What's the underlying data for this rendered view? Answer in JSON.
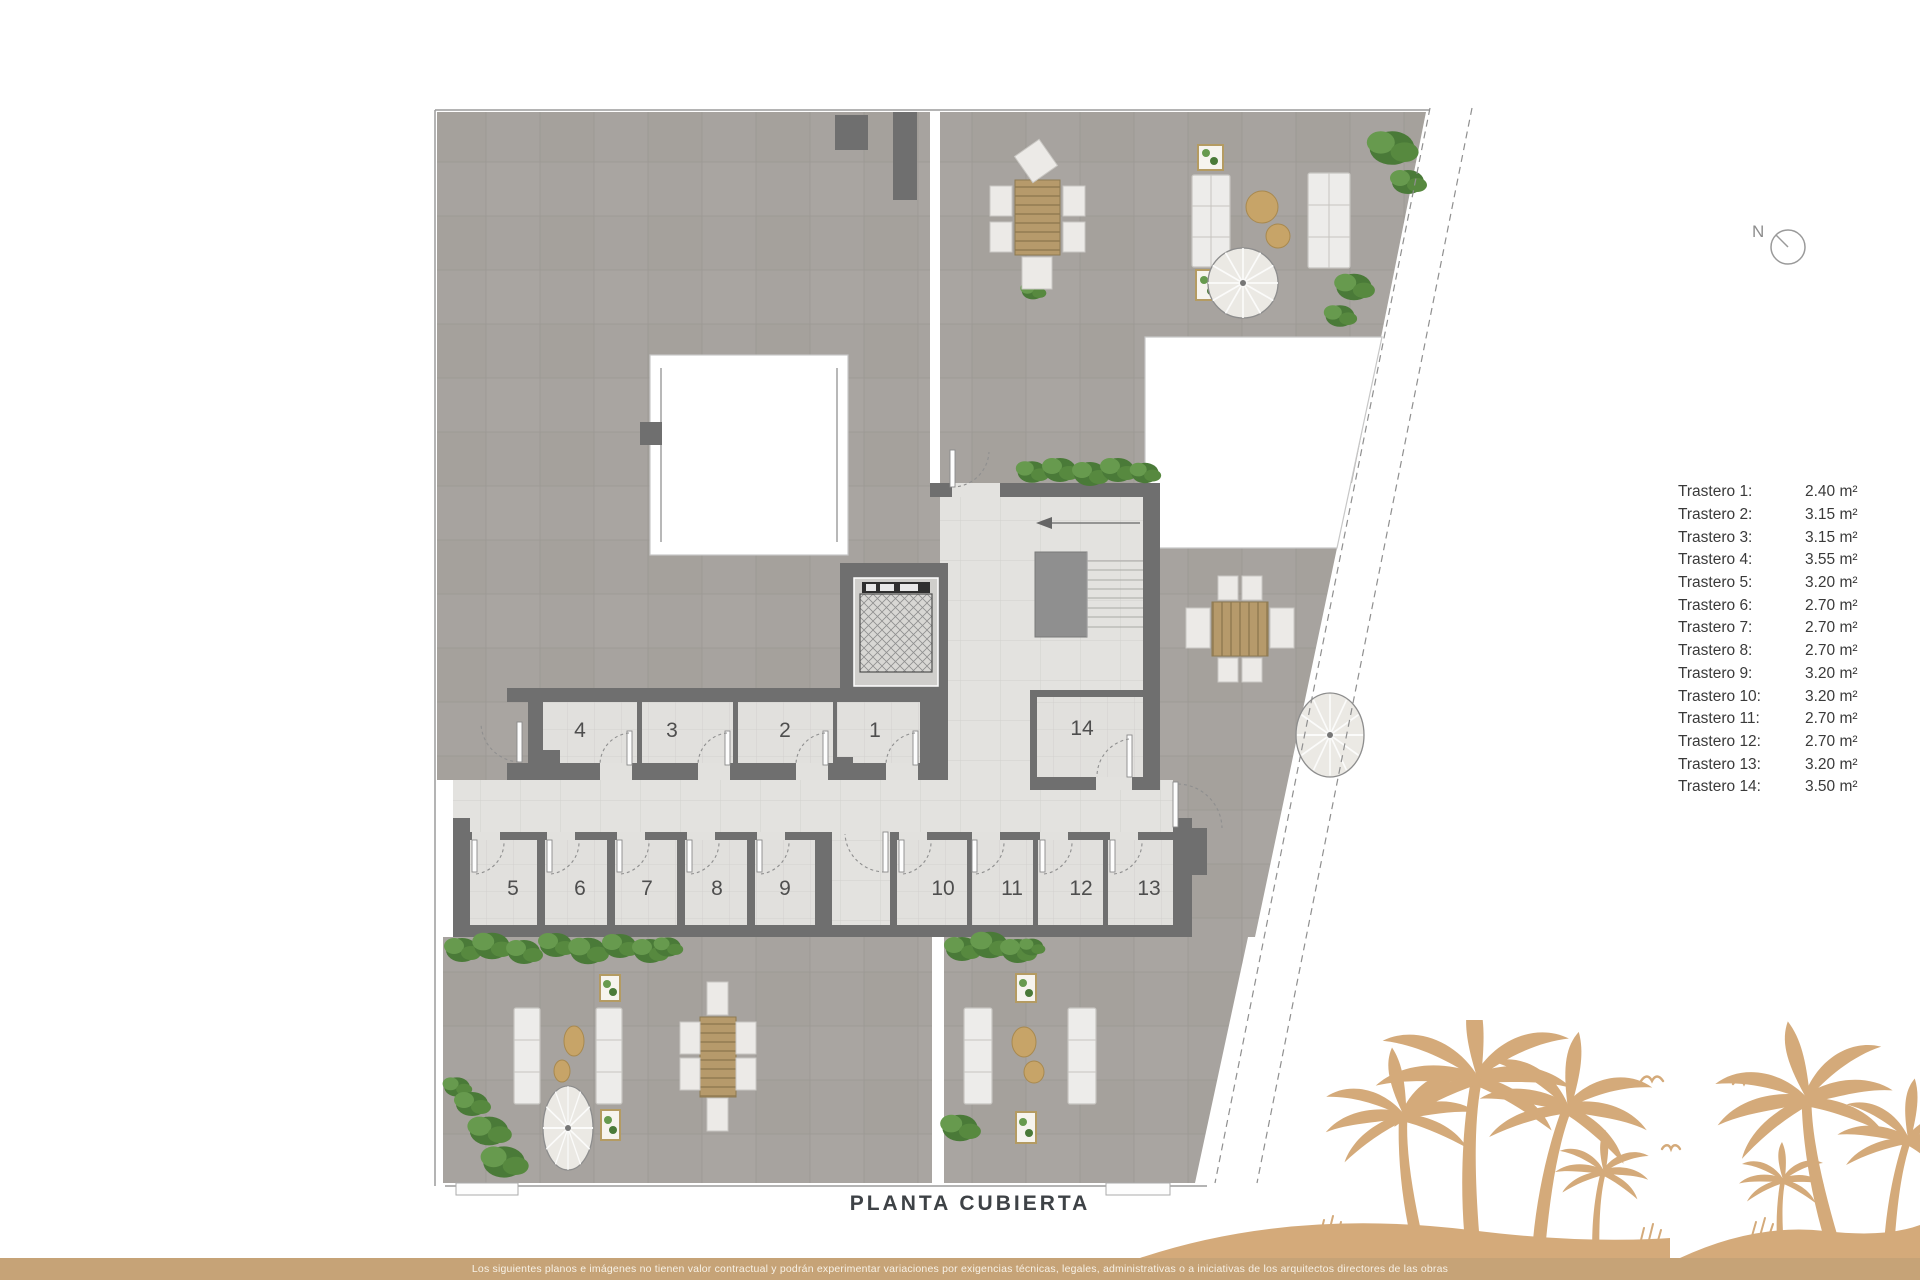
{
  "title": "PLANTA CUBIERTA",
  "north_label": "N",
  "disclaimer": "Los siguientes planos e imágenes no tienen valor contractual y podrán experimentar variaciones por exigencias técnicas, legales, administrativas o a iniciativas de los arquitectos directores de las obras",
  "legend": {
    "rows": [
      {
        "label": "Trastero 1:",
        "value": "2.40 m²"
      },
      {
        "label": "Trastero 2:",
        "value": "3.15 m²"
      },
      {
        "label": "Trastero 3:",
        "value": "3.15 m²"
      },
      {
        "label": "Trastero 4:",
        "value": "3.55 m²"
      },
      {
        "label": "Trastero 5:",
        "value": "3.20 m²"
      },
      {
        "label": "Trastero 6:",
        "value": "2.70 m²"
      },
      {
        "label": "Trastero 7:",
        "value": "2.70 m²"
      },
      {
        "label": "Trastero 8:",
        "value": "2.70 m²"
      },
      {
        "label": "Trastero 9:",
        "value": "3.20 m²"
      },
      {
        "label": "Trastero 10:",
        "value": "3.20 m²"
      },
      {
        "label": "Trastero 11:",
        "value": "2.70 m²"
      },
      {
        "label": "Trastero 12:",
        "value": "2.70 m²"
      },
      {
        "label": "Trastero 13:",
        "value": "3.20 m²"
      },
      {
        "label": "Trastero 14:",
        "value": "3.50 m²"
      }
    ]
  },
  "rooms": [
    {
      "number": "1",
      "x": 875,
      "y": 731
    },
    {
      "number": "2",
      "x": 785,
      "y": 731
    },
    {
      "number": "3",
      "x": 672,
      "y": 731
    },
    {
      "number": "4",
      "x": 580,
      "y": 731
    },
    {
      "number": "5",
      "x": 513,
      "y": 889
    },
    {
      "number": "6",
      "x": 580,
      "y": 889
    },
    {
      "number": "7",
      "x": 647,
      "y": 889
    },
    {
      "number": "8",
      "x": 717,
      "y": 889
    },
    {
      "number": "9",
      "x": 785,
      "y": 889
    },
    {
      "number": "10",
      "x": 943,
      "y": 889
    },
    {
      "number": "11",
      "x": 1012,
      "y": 889
    },
    {
      "number": "12",
      "x": 1081,
      "y": 889
    },
    {
      "number": "13",
      "x": 1149,
      "y": 889
    },
    {
      "number": "14",
      "x": 1082,
      "y": 729
    }
  ],
  "colors": {
    "terrace_tile": "#a7a39f",
    "light_tile": "#e2e1de",
    "wall": "#6f6f6f",
    "wood": "#b69a6b",
    "green": "#55833d",
    "palm_tan": "#d4aa7a",
    "bar_tan": "#c6a377",
    "title_gray": "#3e4246"
  }
}
